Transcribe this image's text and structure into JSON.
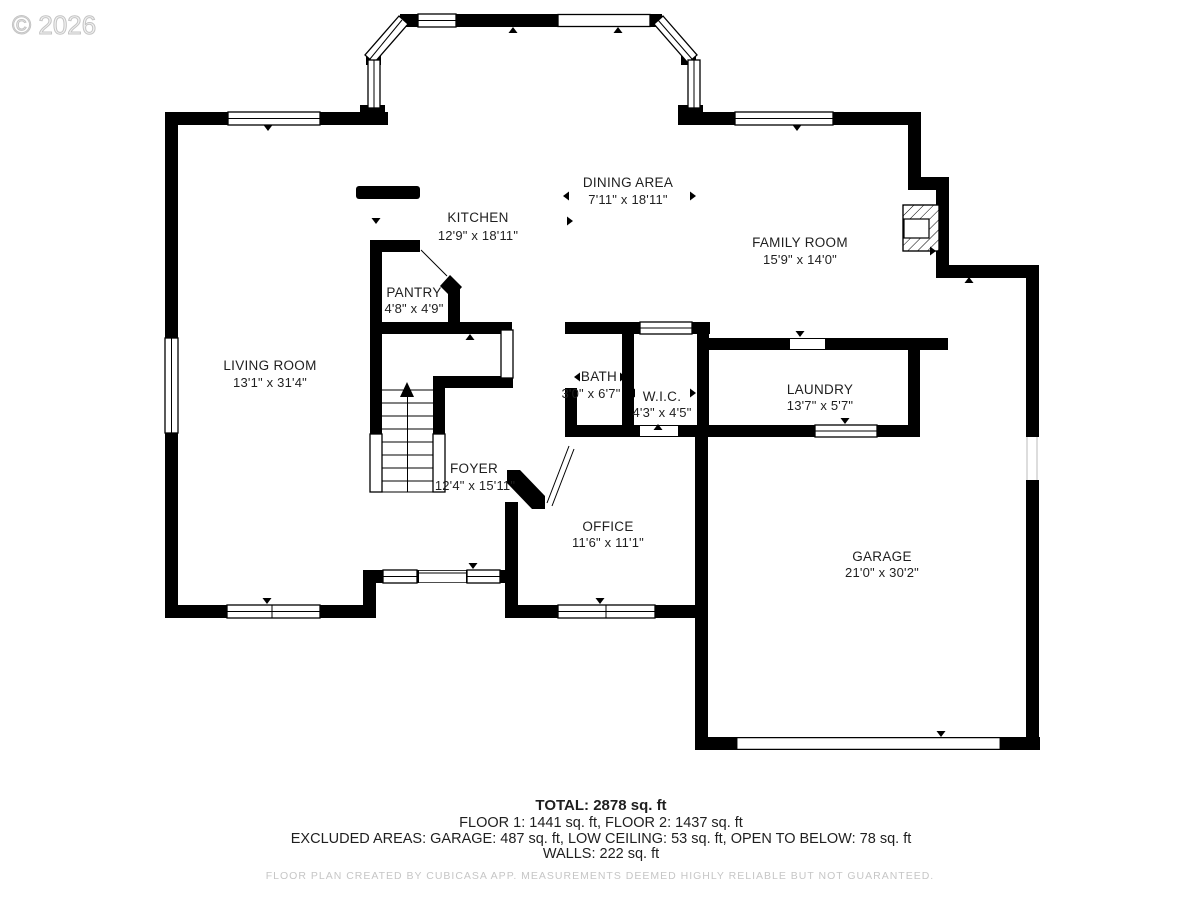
{
  "watermark": "© 2026",
  "rooms": [
    {
      "name": "DINING AREA",
      "dims": "7'11\" x 18'11\""
    },
    {
      "name": "KITCHEN",
      "dims": "12'9\" x 18'11\""
    },
    {
      "name": "FAMILY ROOM",
      "dims": "15'9\" x 14'0\""
    },
    {
      "name": "PANTRY",
      "dims": "4'8\" x 4'9\""
    },
    {
      "name": "LIVING ROOM",
      "dims": "13'1\" x 31'4\""
    },
    {
      "name": "BATH",
      "dims": "3'0\" x 6'7\""
    },
    {
      "name": "W.I.C.",
      "dims": "4'3\" x 4'5\""
    },
    {
      "name": "LAUNDRY",
      "dims": "13'7\" x 5'7\""
    },
    {
      "name": "FOYER",
      "dims": "12'4\" x 15'11\""
    },
    {
      "name": "OFFICE",
      "dims": "11'6\" x 11'1\""
    },
    {
      "name": "GARAGE",
      "dims": "21'0\" x 30'2\""
    }
  ],
  "summary": {
    "total": "TOTAL: 2878 sq. ft",
    "floors": "FLOOR 1: 1441 sq. ft, FLOOR 2: 1437 sq. ft",
    "excluded": "EXCLUDED AREAS: GARAGE: 487 sq. ft, LOW CEILING: 53 sq. ft, OPEN TO BELOW: 78 sq. ft",
    "walls": "WALLS: 222 sq. ft"
  },
  "footer": "FLOOR PLAN CREATED BY CUBICASA APP. MEASUREMENTS DEEMED HIGHLY RELIABLE BUT NOT GUARANTEED.",
  "colors": {
    "wall": "#000000",
    "watermark": "#d2d2d2",
    "footer_text": "#c6c6c6"
  }
}
